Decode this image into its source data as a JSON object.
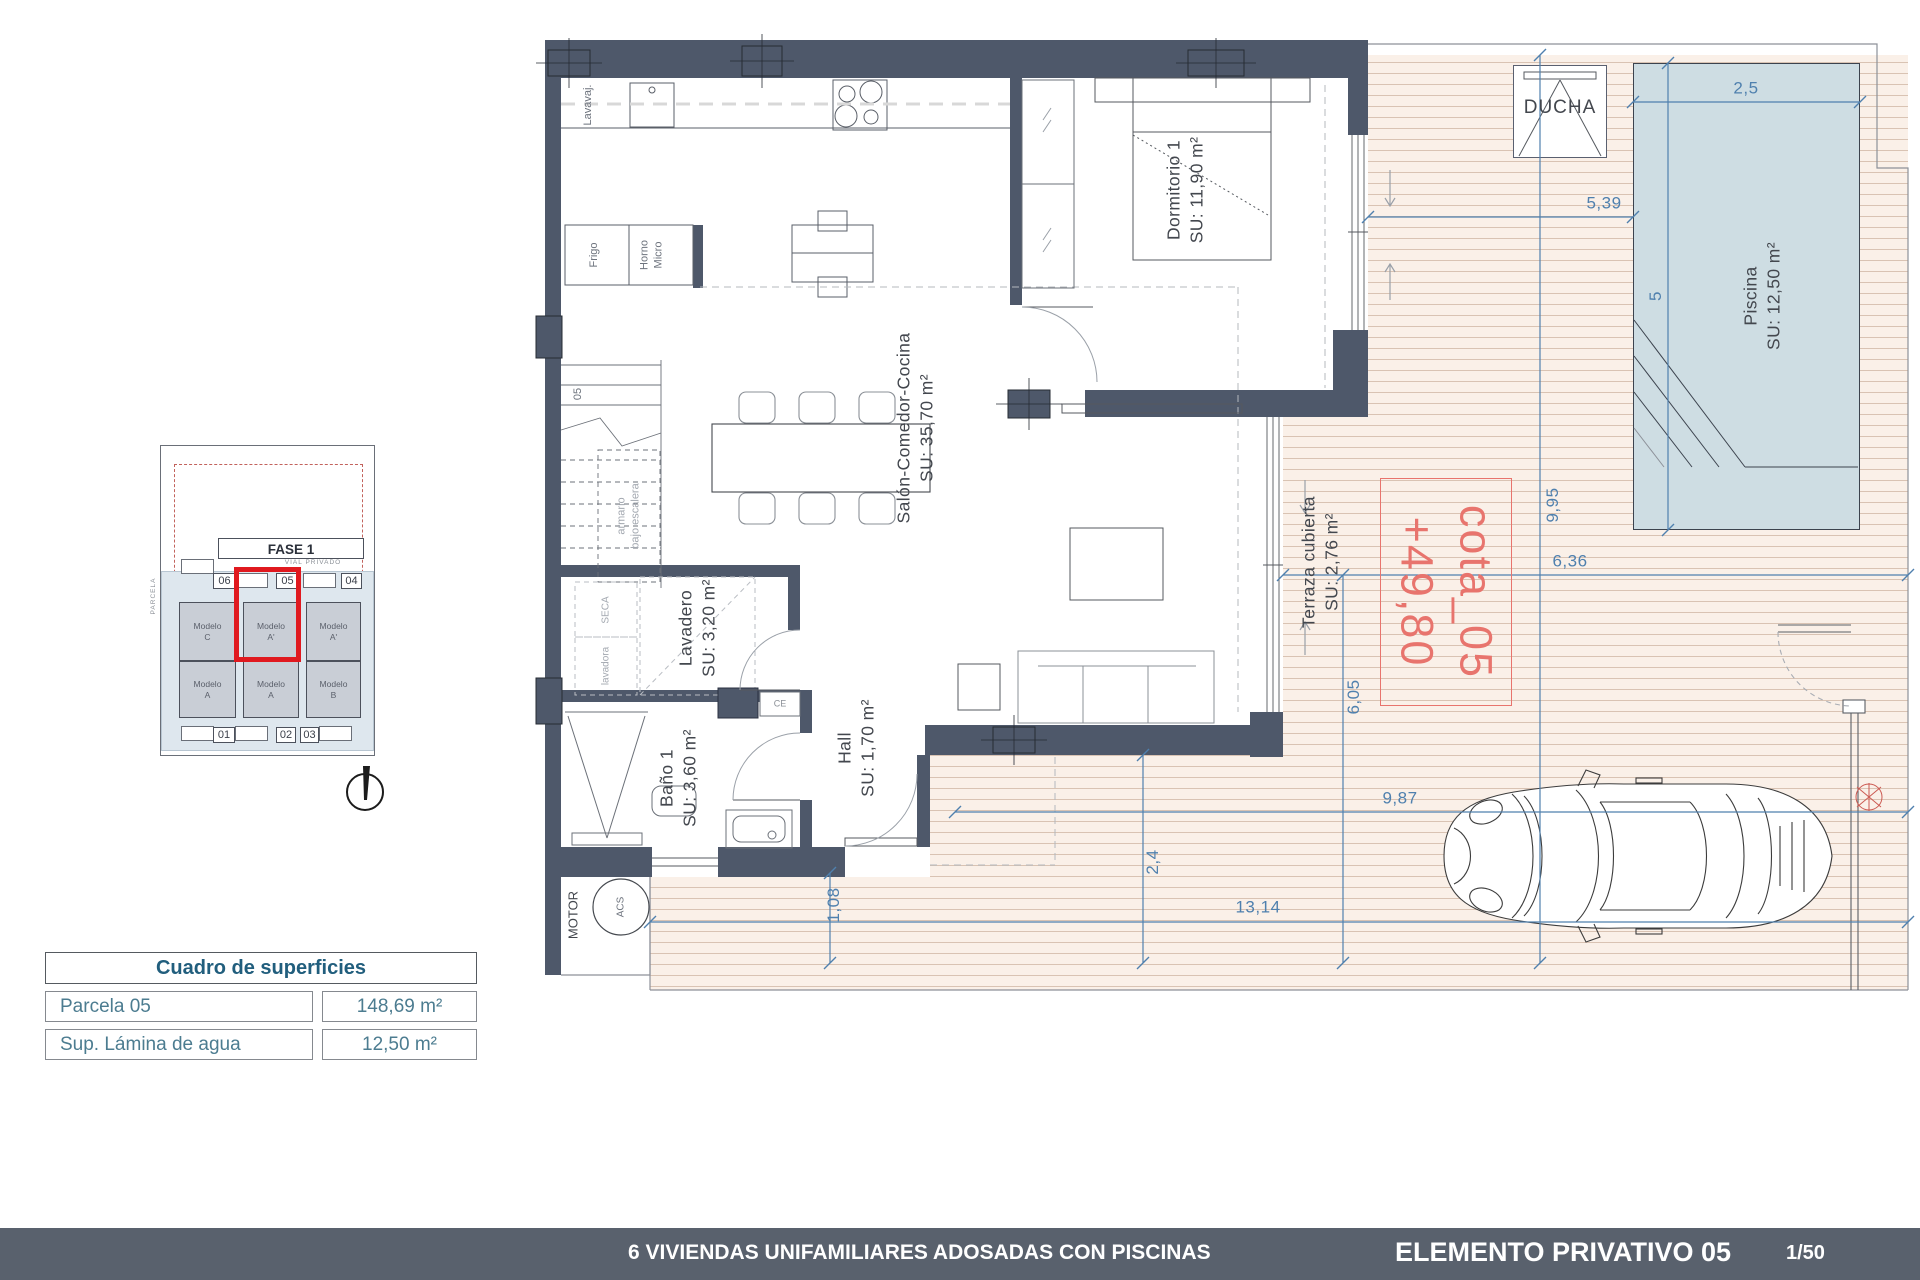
{
  "colors": {
    "wall": "#4E586A",
    "deck_bg": "#FAF0E8",
    "deck_line": "#D9C3B3",
    "pool": "#CEDDE3",
    "dimension_blue": "#4F80AE",
    "cota_red": "#E8746D",
    "highlight_red": "#E0191F",
    "footer_bar": "#59616D",
    "table_accent": "#215E7D"
  },
  "rooms": {
    "dormitorio": {
      "name": "Dormitorio 1",
      "area": "SU: 11,90 m²"
    },
    "salon": {
      "name": "Salón-Comedor-Cocina",
      "area": "SU: 35,70 m²"
    },
    "lavadero": {
      "name": "Lavadero",
      "area": "SU: 3,20 m²"
    },
    "bano": {
      "name": "Baño 1",
      "area": "SU: 3,60 m²"
    },
    "hall": {
      "name": "Hall",
      "area": "SU: 1,70 m²"
    },
    "terraza": {
      "name": "Terraza cubierta",
      "area": "SU: 2,76 m²"
    },
    "piscina": {
      "name": "Piscina",
      "area": "SU: 12,50 m²"
    }
  },
  "fixtures": {
    "lavavajillas": "Lavavaj.",
    "frigo": "Frigo",
    "horno": {
      "line1": "Horno",
      "line2": "Micro"
    },
    "seca": "SECA",
    "lavadora": "lavadora",
    "armario": {
      "line1": "armario",
      "line2": "bajo escalera"
    },
    "stair_number": "05",
    "motor": "MOTOR",
    "acs": "ACS",
    "ce": "CE",
    "ducha": "DUCHA"
  },
  "dimensions": {
    "pool_width": "2,5",
    "deck_width": "5,39",
    "pool_length": "5",
    "plot_depth": "9,95",
    "terrace_width": "6,36",
    "terrace_depth": "6,05",
    "drive_width": "9,87",
    "drive_depth": "2,4",
    "total_width": "13,14",
    "side_step": "1,08"
  },
  "cota": {
    "name": "cota_05",
    "level": "+49,80"
  },
  "site_plan": {
    "fase": "FASE 1",
    "vial": "VIAL PRIVADO",
    "parcela": "PARCELA",
    "plots": [
      "06",
      "05",
      "04",
      "01",
      "02",
      "03"
    ],
    "models": [
      {
        "line1": "Modelo",
        "line2": "C"
      },
      {
        "line1": "Modelo",
        "line2": "A'"
      },
      {
        "line1": "Modelo",
        "line2": "A'"
      },
      {
        "line1": "Modelo",
        "line2": "A"
      },
      {
        "line1": "Modelo",
        "line2": "A"
      },
      {
        "line1": "Modelo",
        "line2": "B"
      }
    ]
  },
  "surfaces": {
    "title": "Cuadro de superficies",
    "rows": [
      {
        "label": "Parcela 05",
        "value": "148,69 m²"
      },
      {
        "label": "Sup. Lámina de agua",
        "value": "12,50 m²"
      }
    ]
  },
  "footer": {
    "project": "6 VIVIENDAS UNIFAMILIARES ADOSADAS CON PISCINAS",
    "element": "ELEMENTO PRIVATIVO 05",
    "scale": "1/50"
  }
}
